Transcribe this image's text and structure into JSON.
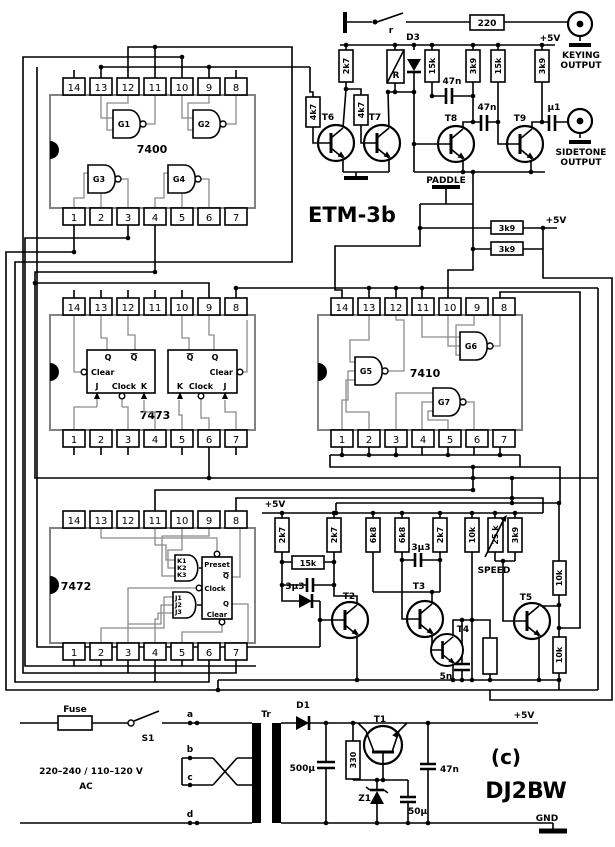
{
  "meta": {
    "model": "ETM-3b",
    "copyright": "(c)",
    "author": "DJ2BW"
  },
  "pins": {
    "top": [
      "14",
      "13",
      "12",
      "11",
      "10",
      "9",
      "8"
    ],
    "bottom": [
      "1",
      "2",
      "3",
      "4",
      "5",
      "6",
      "7"
    ]
  },
  "ics": {
    "u1": {
      "name": "7400",
      "g1": "G1",
      "g2": "G2",
      "g3": "G3",
      "g4": "G4"
    },
    "u2": {
      "name": "7473",
      "q": "Q",
      "qbar": "Q",
      "clear": "Clear",
      "j": "J",
      "clock": "Clock",
      "k": "K"
    },
    "u3": {
      "name": "7410",
      "g5": "G5",
      "g6": "G6",
      "g7": "G7"
    },
    "u4": {
      "name": "7472",
      "k1": "K1",
      "k2": "K2",
      "k3": "K3",
      "j1": "J1",
      "j2": "J2",
      "j3": "J3",
      "preset": "Preset",
      "qbar": "Q",
      "clock": "Clock",
      "q": "Q",
      "clear": "Clear"
    }
  },
  "keyer": {
    "switch_label": "r",
    "r220": "220",
    "keying1": "KEYING",
    "keying2": "OUTPUT",
    "plus5v": "+5V",
    "d3": "D3",
    "relay": "R",
    "r2k7": "2k7",
    "r4k7a": "4k7",
    "r4k7b": "4k7",
    "r15ka": "15k",
    "r3k9a": "3k9",
    "r15kb": "15k",
    "r3k9b": "3k9",
    "c47na": "47n",
    "c47nb": "47n",
    "cu1": "µ1",
    "t6": "T6",
    "t7": "T7",
    "t8": "T8",
    "t9": "T9",
    "sidetone1": "SIDETONE",
    "sidetone2": "OUTPUT"
  },
  "paddle": {
    "label": "PADDLE",
    "r3k9a": "3k9",
    "r3k9b": "3k9",
    "plus5v": "+5V"
  },
  "timing": {
    "plus5v": "+5V",
    "r2k7a": "2k7",
    "r2k7b": "2k7",
    "r6k8a": "6k8",
    "r6k8b": "6k8",
    "r2k7c": "2k7",
    "r10k": "10k",
    "pot": "25 k",
    "speed": "SPEED",
    "r3k9": "3k9",
    "r15k": "15k",
    "c3u3a": "3µ3",
    "c3u3b": "3µ3",
    "t2": "T2",
    "t3": "T3",
    "t4": "T4",
    "t5": "T5",
    "c5n": "5n",
    "r10ka": "10k",
    "r10kb": "10k"
  },
  "power": {
    "fuse": "Fuse",
    "s1": "S1",
    "ta": "a",
    "tb": "b",
    "tc": "c",
    "td": "d",
    "voltage": "220–240 / 110–120 V",
    "ac": "AC",
    "tr": "Tr",
    "d1": "D1",
    "c500u": "500µ",
    "r330": "330",
    "t1": "T1",
    "z1": "Z1",
    "c50u": "50µ",
    "c47n": "47n",
    "plus5v": "+5V",
    "gnd": "GND"
  }
}
